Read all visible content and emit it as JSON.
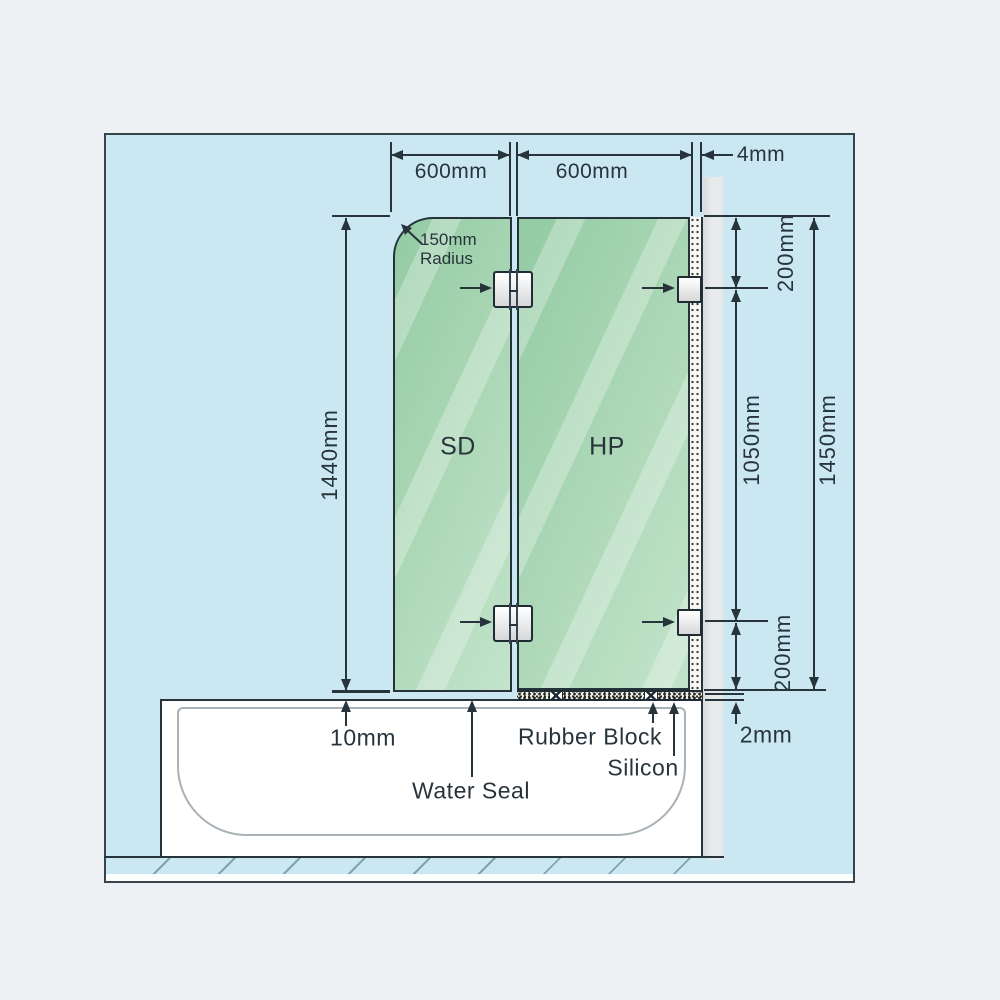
{
  "diagram": {
    "panels": {
      "left_label": "SD",
      "right_label": "HP"
    },
    "dims": {
      "panel1_width": "600mm",
      "panel2_width": "600mm",
      "wall_gap": "4mm",
      "door_height": "1440mm",
      "radius_line1": "150mm",
      "radius_line2": "Radius",
      "top_bracket_offset": "200mm",
      "bracket_spacing": "1050mm",
      "fixed_panel_height": "1450mm",
      "bottom_bracket_offset": "200mm",
      "door_bottom_gap": "10mm",
      "bottom_seal_gap": "2mm"
    },
    "annotations": {
      "water_seal": "Water Seal",
      "rubber_block": "Rubber Block",
      "silicon": "Silicon"
    },
    "colors": {
      "glass_green": "#a9d6b4",
      "background_blue": "#cbe8f2",
      "wall_gray": "#e3e6e8",
      "line": "#28343c"
    }
  }
}
